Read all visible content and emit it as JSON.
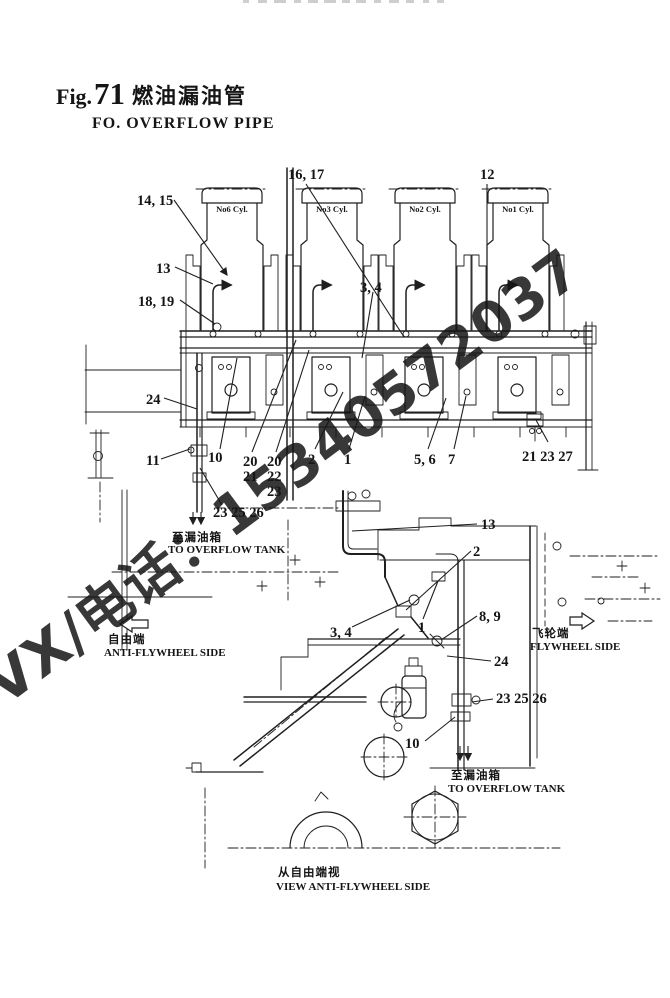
{
  "header": {
    "fig_label": "Fig.",
    "fig_number": "71",
    "title_cn": "燃油漏油管",
    "title_en": "FO. OVERFLOW PIPE"
  },
  "watermark": {
    "text": "VX/电话：15340572037",
    "color": "#29A6E0"
  },
  "side_view": {
    "cylinders": [
      "No6 Cyl.",
      "No3 Cyl.",
      "No2 Cyl.",
      "No1 Cyl."
    ],
    "callouts": {
      "c14_15": "14, 15",
      "c16_17": "16, 17",
      "c12": "12",
      "c13": "13",
      "c18_19": "18, 19",
      "c24": "24",
      "c11": "11",
      "c10": "10",
      "c20a": "20",
      "c21a": "21",
      "c20b": "20",
      "c22b": "22",
      "c23c": "23",
      "c2": "2",
      "c1": "1",
      "c3_4": "3, 4",
      "c5_6": "5, 6",
      "c7": "7",
      "c21_23_27": "21 23 27",
      "c23_25_26": "23 25 26"
    },
    "labels": {
      "to_tank_cn": "至漏油箱",
      "to_tank_en": "TO OVERFLOW TANK",
      "free_cn": "自由端",
      "free_en": "ANTI-FLYWHEEL SIDE",
      "fly_cn": "飞轮端",
      "fly_en": "FLYWHEEL SIDE"
    }
  },
  "end_view": {
    "callouts": {
      "c13": "13",
      "c2": "2",
      "c3_4": "3, 4",
      "c1": "1",
      "c8_9": "8, 9",
      "c24": "24",
      "c23_25_26": "23 25 26",
      "c10": "10"
    },
    "labels": {
      "to_tank_cn": "至漏油箱",
      "to_tank_en": "TO OVERFLOW TANK",
      "caption_cn": "从自由端视",
      "caption_en": "VIEW ANTI-FLYWHEEL SIDE"
    }
  }
}
